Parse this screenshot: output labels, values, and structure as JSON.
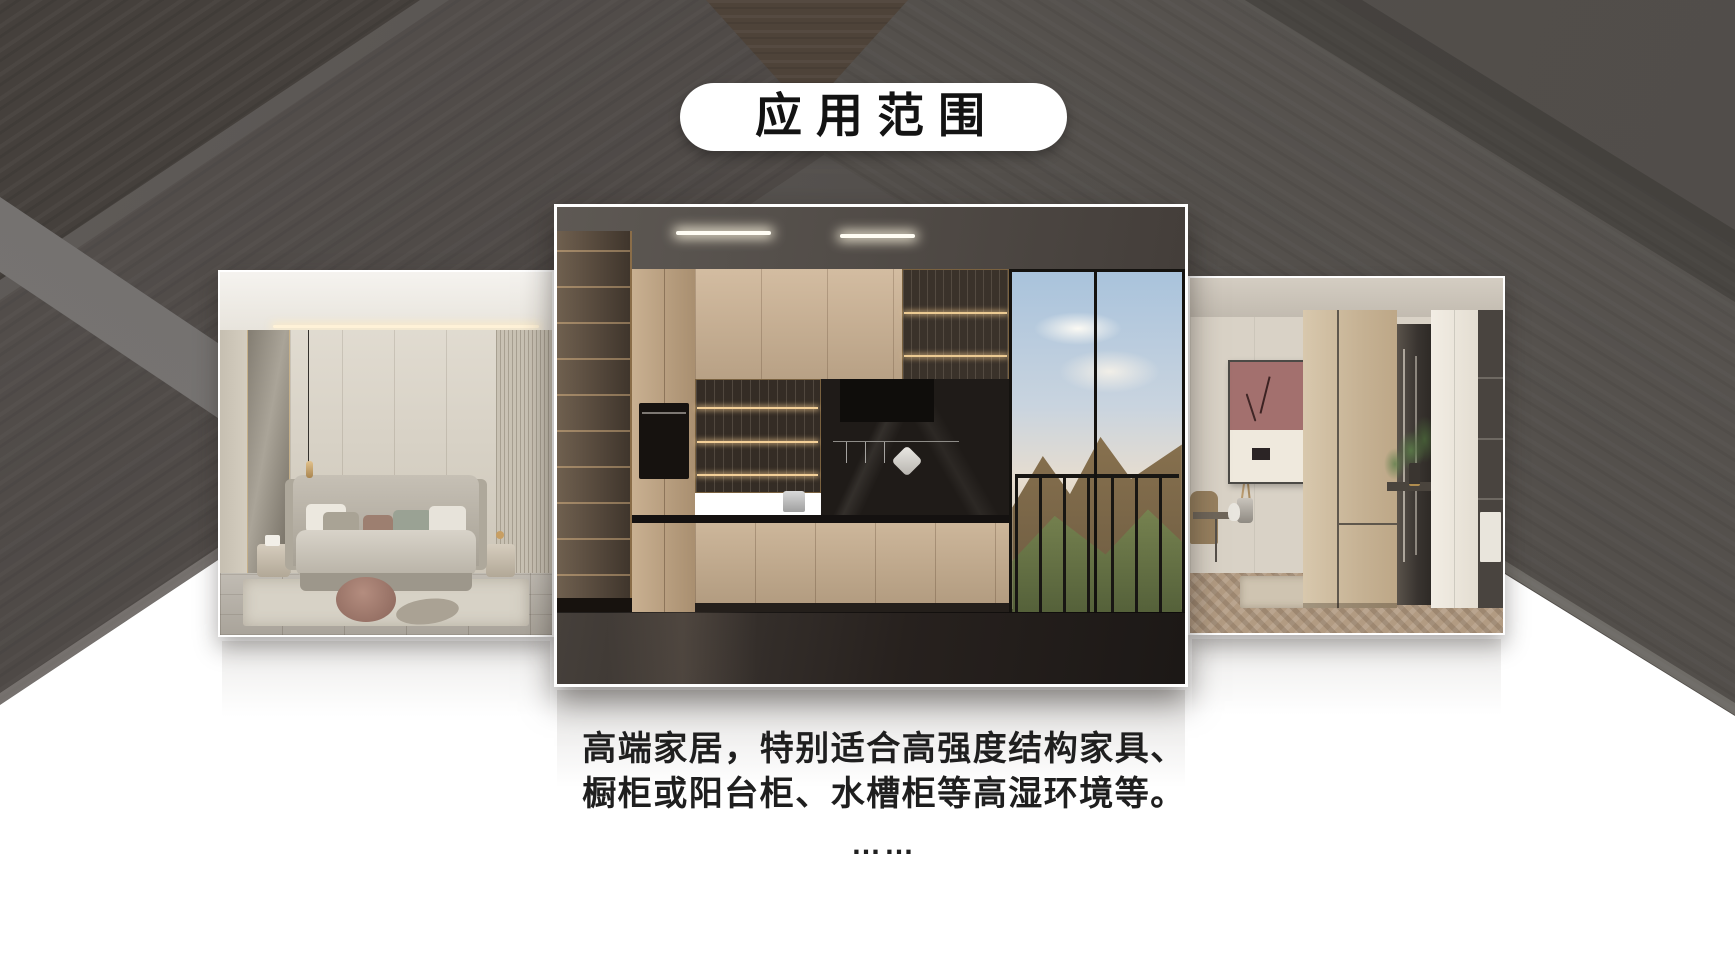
{
  "header": {
    "badge_label": "应用范围"
  },
  "caption": {
    "line1": "高端家居，特别适合高强度结构家具、",
    "line2": "橱柜或阳台柜、水槽柜等高湿环境等。",
    "ellipsis": "……"
  },
  "gallery": {
    "images": [
      {
        "name": "bedroom-scene"
      },
      {
        "name": "kitchen-scene"
      },
      {
        "name": "entryway-scene"
      }
    ]
  },
  "colors": {
    "background_dark": "#534F4C",
    "wood_panel": "#4A4643",
    "light_band": "#716E6C",
    "foreground_white": "#FFFFFF",
    "badge_background": "#FFFFFF",
    "text": "#1C1C1C"
  }
}
